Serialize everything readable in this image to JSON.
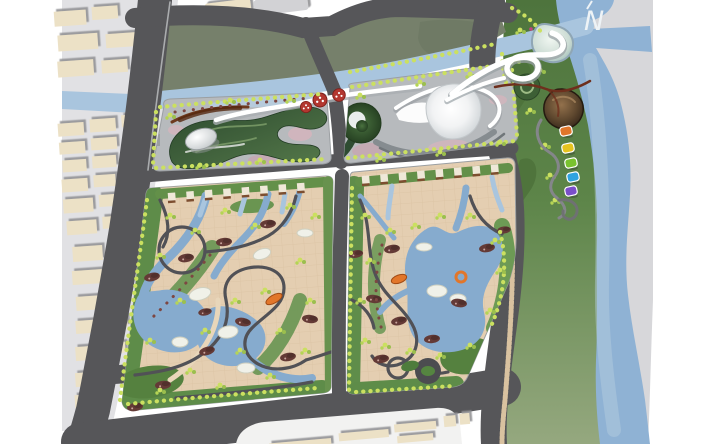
{
  "meta": {
    "image_type": "landscape masterplan aerial site plan rendering",
    "canvas": {
      "width": 718,
      "height": 444
    }
  },
  "north_indicator": {
    "label": "N",
    "color": "#eef3f6"
  },
  "palette": {
    "page_background": "#ffffff",
    "district_ground": "#e1e1e4",
    "district_building": "#ece1c6",
    "southeast_district_ground": "#f2f2f1",
    "road": "#565659",
    "water_river": "#8fb2d4",
    "water_canal": "#a9c5de",
    "park_water": "#86abce",
    "buffer_olive": "#76806b",
    "park_paving_north": "#b7babd",
    "park_paving_south_tan": "#e4ceb1",
    "park_green_dark": "#2c4a2e",
    "park_green": "#5f8d4a",
    "lawn_south": "#93a77e",
    "tree_dot_yellow_green": "#cbe060",
    "tree_dot_red": "#7d4742",
    "tree_cluster_maroon": "#643a36",
    "accent_red_pavilion": "#b33730",
    "accent_orange": "#e2762a",
    "ribbon_white": "#ffffff",
    "pink_landform": "#c7a7b1",
    "east_bank": "#d7d7da"
  },
  "riverside": {
    "pavilion_colors": [
      "#e0762b",
      "#e6c31f",
      "#79c22f",
      "#2fa3e0",
      "#7a4fc9"
    ],
    "pavilion_count": 5
  },
  "park_blocks": {
    "north_count": 2,
    "south_count": 2
  }
}
